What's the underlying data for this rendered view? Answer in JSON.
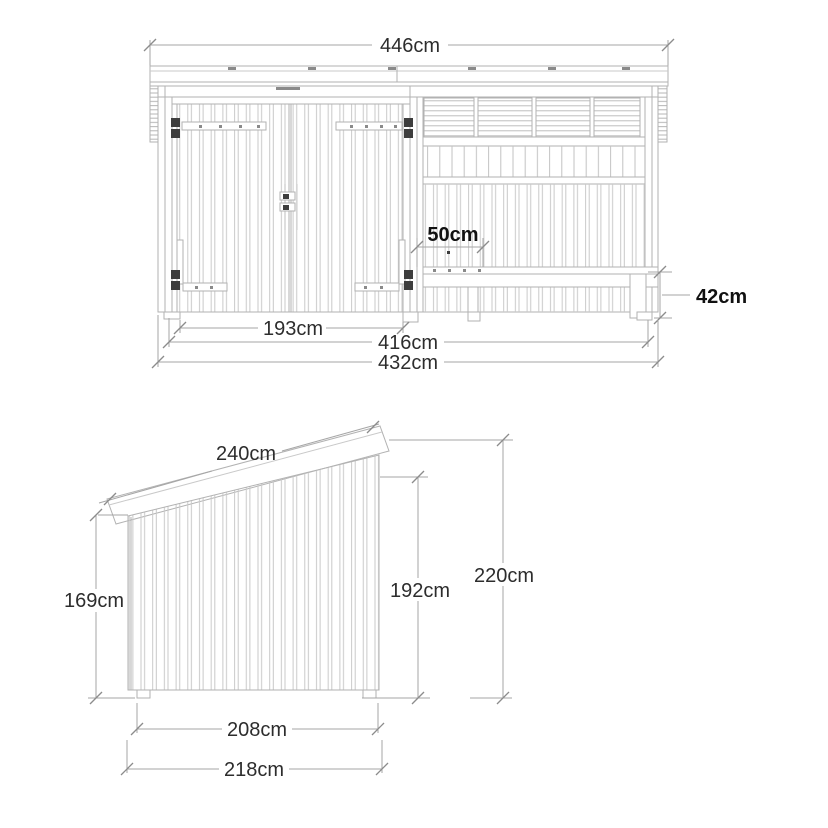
{
  "drawing": {
    "type": "technical-drawing",
    "colors": {
      "background": "#ffffff",
      "outline": "#b2b2b2",
      "plank_line": "#c9c9c9",
      "dimension_line": "#a6a6a6",
      "tick": "#8c8c8c",
      "text": "#2d2d2d",
      "bold_text": "#111111",
      "hardware": "#3d3d3d"
    },
    "front_view": {
      "name": "front-elevation",
      "dims": {
        "total_width": "446cm",
        "door_opening_width": "193cm",
        "inner_width": "416cm",
        "overall_width": "432cm",
        "bench_depth": "50cm",
        "bench_height": "42cm"
      }
    },
    "side_view": {
      "name": "side-elevation",
      "dims": {
        "roof_length": "240cm",
        "rear_height": "169cm",
        "front_height": "192cm",
        "total_height": "220cm",
        "inner_depth": "208cm",
        "overall_depth": "218cm"
      }
    }
  }
}
